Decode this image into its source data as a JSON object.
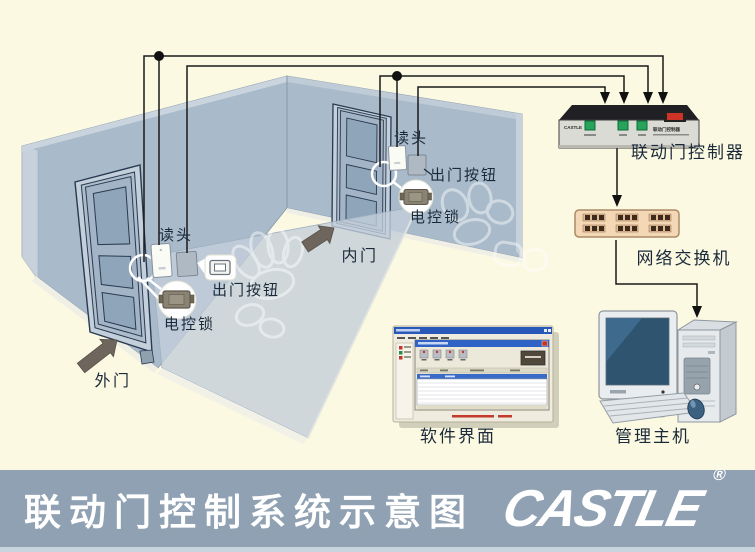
{
  "footer": {
    "title": "联动门控制系统示意图",
    "logo": "CASTLE",
    "registered": "®"
  },
  "room": {
    "outer_door_label": "外门",
    "inner_door_label": "内门"
  },
  "devices": {
    "outer_reader": "读头",
    "outer_exit_button": "出门按钮",
    "outer_lock": "电控锁",
    "inner_reader": "读头",
    "inner_exit_button": "出门按钮",
    "inner_lock": "电控锁"
  },
  "equipment": {
    "controller_label": "联动门控制器",
    "controller_brand": "CASTLE",
    "controller_panel_text": "联动门控制器",
    "switch_label": "网络交换机",
    "software_label": "软件界面",
    "host_label": "管理主机"
  },
  "colors": {
    "background": "#FCF9E2",
    "wall": "#A9BACA",
    "wall_edge": "#C6D1DB",
    "front_panel": "#C3CEDA",
    "door_line": "#2A3A52",
    "wire": "#1A1A1A",
    "controller_top": "#202024",
    "controller_face": "#DBDBD5",
    "button_green": "#27A35C",
    "switch_red": "#CE3328",
    "switch_body": "#F4D8B6",
    "port_dark": "#3E2A1C",
    "screen_blue": "#2E5470",
    "footer_bar": "#8FA1B2"
  }
}
